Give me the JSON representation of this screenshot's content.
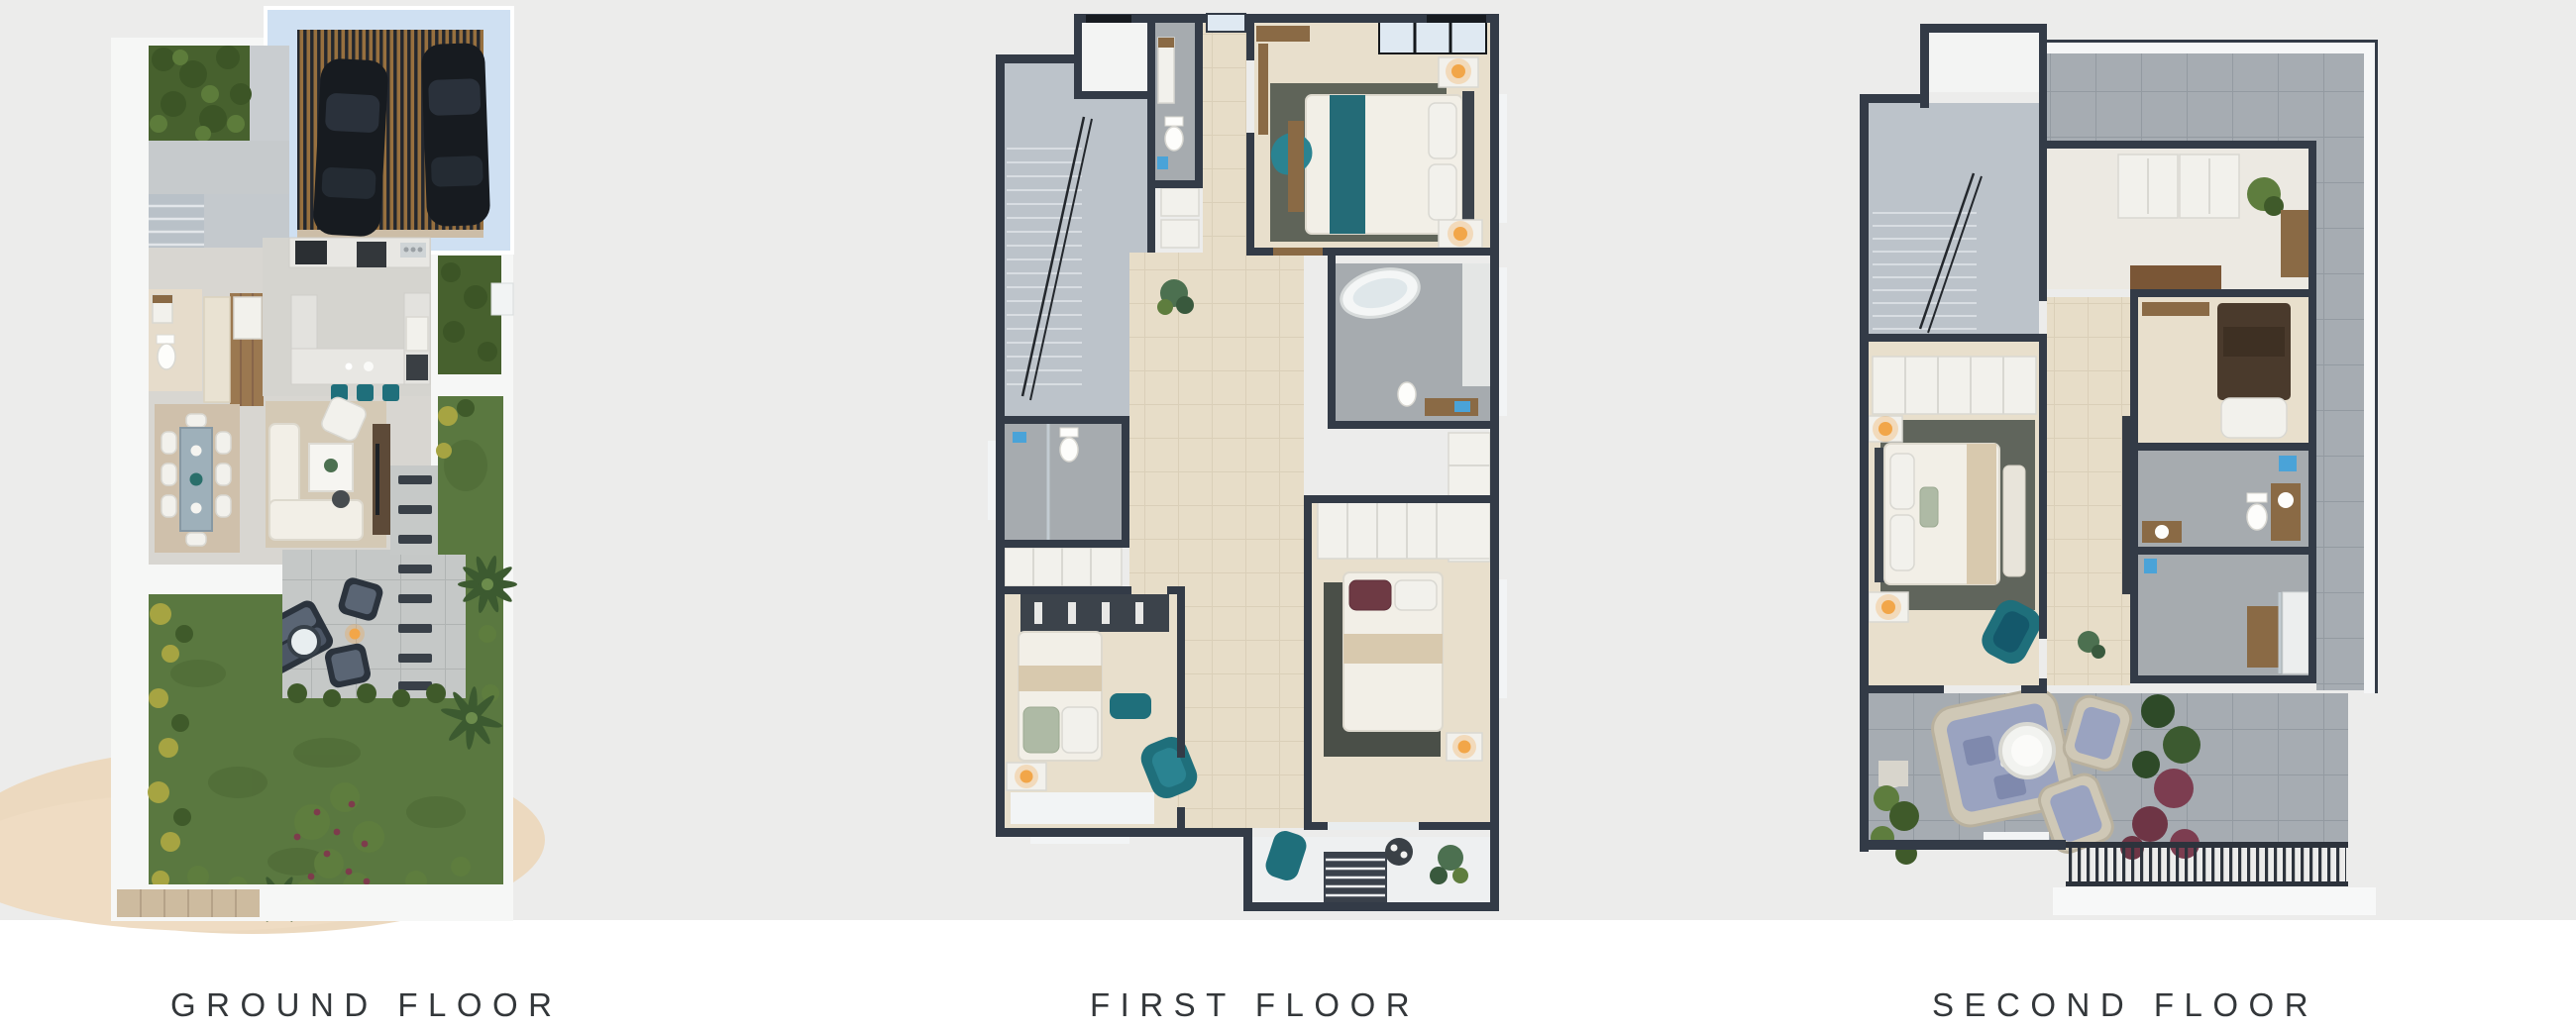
{
  "page": {
    "background_top": "#ECECEB",
    "background_bottom": "#FFFFFF",
    "label_color": "#33373A"
  },
  "plans": [
    {
      "id": "ground-floor",
      "label": "GROUND FLOOR"
    },
    {
      "id": "first-floor",
      "label": "FIRST FLOOR"
    },
    {
      "id": "second-floor",
      "label": "SECOND FLOOR"
    }
  ],
  "palette": {
    "wall_dark": "#333B47",
    "driveway_blue": "#CFE0F2",
    "pergola_wood": "#97703F",
    "car_black": "#171B20",
    "lawn_green": "#5A7840",
    "hedge_green": "#47612E",
    "sand": "#ECD9BF",
    "floor_beige": "#E8DFCC",
    "tile_gray": "#A6ABAF",
    "marble_gray": "#BCC3CA",
    "terrace_tile": "#A6ACB2",
    "teal_accent": "#1F6F7B",
    "wood_brown": "#8A6A45",
    "lamp_orange": "#F2A649",
    "cushion_lavender": "#9AA3C0",
    "bg_top": "#ECECEB",
    "bg_bottom": "#FFFFFF",
    "label_color": "#33373A"
  }
}
